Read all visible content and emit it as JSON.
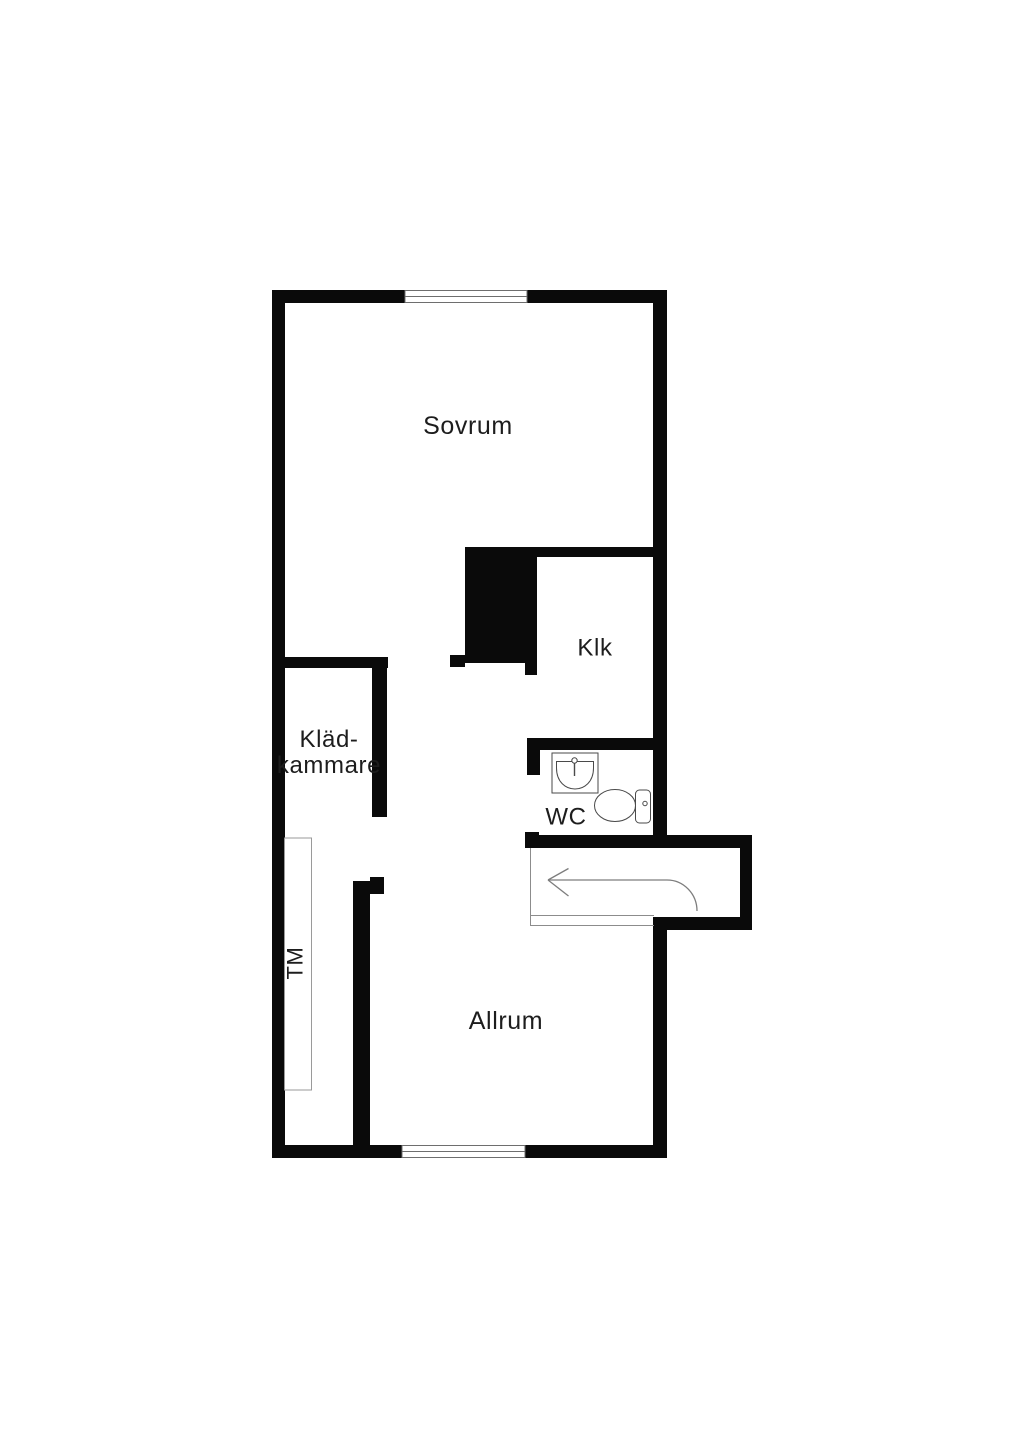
{
  "canvas": {
    "width": 1024,
    "height": 1448
  },
  "colors": {
    "background": "#ffffff",
    "wall": "#0a0a0a",
    "window_line": "#6e6e6e",
    "thin_line": "#8c8c8c",
    "arrow": "#7d7d7d",
    "fixture": "#4a4a4a",
    "tm_line": "#9a9a9a",
    "text": "#1d1d1d"
  },
  "labels": [
    {
      "name": "room-label-sovrum",
      "text": "Sovrum",
      "x": 468,
      "y": 426,
      "size": 25,
      "rotate": 0
    },
    {
      "name": "room-label-klk",
      "text": "Klk",
      "x": 595,
      "y": 648,
      "size": 24,
      "rotate": 0
    },
    {
      "name": "room-label-kladkammare",
      "lines": [
        "Kläd-",
        "kammare"
      ],
      "x": 329,
      "y": 739,
      "line_height": 26,
      "size": 24,
      "rotate": 0
    },
    {
      "name": "room-label-wc",
      "text": "WC",
      "x": 566,
      "y": 817,
      "size": 24,
      "rotate": 0
    },
    {
      "name": "room-label-allrum",
      "text": "Allrum",
      "x": 506,
      "y": 1021,
      "size": 25,
      "rotate": 0
    },
    {
      "name": "label-tm",
      "text": "TM",
      "x": 295,
      "y": 963,
      "size": 22,
      "rotate": -90
    }
  ],
  "walls": [
    {
      "name": "outer-top-wall-left",
      "x": 272,
      "y": 290,
      "w": 133,
      "h": 13
    },
    {
      "name": "outer-top-wall-right",
      "x": 527,
      "y": 290,
      "w": 140,
      "h": 13
    },
    {
      "name": "outer-left-wall",
      "x": 272,
      "y": 290,
      "w": 13,
      "h": 868
    },
    {
      "name": "outer-right-wall-upper",
      "x": 653,
      "y": 290,
      "w": 14,
      "h": 558
    },
    {
      "name": "outer-right-wall-lower",
      "x": 653,
      "y": 917,
      "w": 14,
      "h": 241
    },
    {
      "name": "outer-bottom-wall-left",
      "x": 272,
      "y": 1145,
      "w": 130,
      "h": 13
    },
    {
      "name": "outer-bottom-wall-right",
      "x": 525,
      "y": 1145,
      "w": 142,
      "h": 13
    },
    {
      "name": "kladkammare-top-wall",
      "x": 280,
      "y": 657,
      "w": 108,
      "h": 11
    },
    {
      "name": "kladkammare-right-wall",
      "x": 372,
      "y": 657,
      "w": 15,
      "h": 160
    },
    {
      "name": "shaft-block",
      "x": 465,
      "y": 547,
      "w": 72,
      "h": 116
    },
    {
      "name": "shaft-stub-left",
      "x": 450,
      "y": 655,
      "w": 15,
      "h": 12
    },
    {
      "name": "shaft-ext-bottom",
      "x": 525,
      "y": 663,
      "w": 12,
      "h": 12
    },
    {
      "name": "klk-top-wall",
      "x": 537,
      "y": 547,
      "w": 128,
      "h": 10
    },
    {
      "name": "klk-bottom-wc-top-wall",
      "x": 527,
      "y": 738,
      "w": 138,
      "h": 12
    },
    {
      "name": "wc-left-stub",
      "x": 527,
      "y": 738,
      "w": 13,
      "h": 37
    },
    {
      "name": "hall-top-wall",
      "x": 527,
      "y": 835,
      "w": 225,
      "h": 13
    },
    {
      "name": "hall-top-wall-endcap",
      "x": 525,
      "y": 832,
      "w": 14,
      "h": 16
    },
    {
      "name": "vestibule-right-wall",
      "x": 740,
      "y": 835,
      "w": 12,
      "h": 95
    },
    {
      "name": "vestibule-bottom-wall",
      "x": 655,
      "y": 917,
      "w": 97,
      "h": 13
    },
    {
      "name": "laundry-wall",
      "x": 353,
      "y": 881,
      "w": 17,
      "h": 277
    },
    {
      "name": "laundry-wall-hook",
      "x": 370,
      "y": 877,
      "w": 14,
      "h": 17
    }
  ],
  "windows": [
    {
      "name": "window-top",
      "x": 405,
      "y": 290.5,
      "w": 122,
      "h": 12
    },
    {
      "name": "window-bottom",
      "x": 402,
      "y": 1145.5,
      "w": 123,
      "h": 12
    }
  ],
  "threshold_lines": [
    {
      "name": "hall-edge-line",
      "x1": 530.5,
      "y1": 848,
      "x2": 530.5,
      "y2": 926
    },
    {
      "name": "threshold-line-top",
      "x1": 530.5,
      "y1": 915.5,
      "x2": 654,
      "y2": 915.5
    },
    {
      "name": "threshold-line-bottom",
      "x1": 530.5,
      "y1": 925.5,
      "x2": 654,
      "y2": 925.5
    }
  ],
  "tm_unit": {
    "name": "washing-machine-outline",
    "x": 284.5,
    "y": 838,
    "w": 27,
    "h": 252
  },
  "entrance_arrow": {
    "swing_path": "M697,911 A30,31 0 0 0 667,880 L548,880",
    "barbs": [
      "M548,880 L568.5,868.5",
      "M548,880 L568.5,896"
    ]
  },
  "fixtures": {
    "sink": {
      "box": [
        552,
        753,
        46,
        40
      ],
      "basin_path": "M556.5,761.5 L593.5,761.5 L593.5,768 C593.5,796 556.5,796 556.5,768 Z",
      "faucet_circle": [
        574.5,
        760.5,
        2.7
      ],
      "faucet_stem": [
        574.5,
        763.5,
        574.5,
        776
      ]
    },
    "toilet": {
      "bowl": [
        615,
        805.5,
        20.5,
        16
      ],
      "tank": [
        635.5,
        790,
        15,
        33,
        4
      ],
      "knob": [
        645,
        803.5,
        2.2
      ]
    }
  }
}
